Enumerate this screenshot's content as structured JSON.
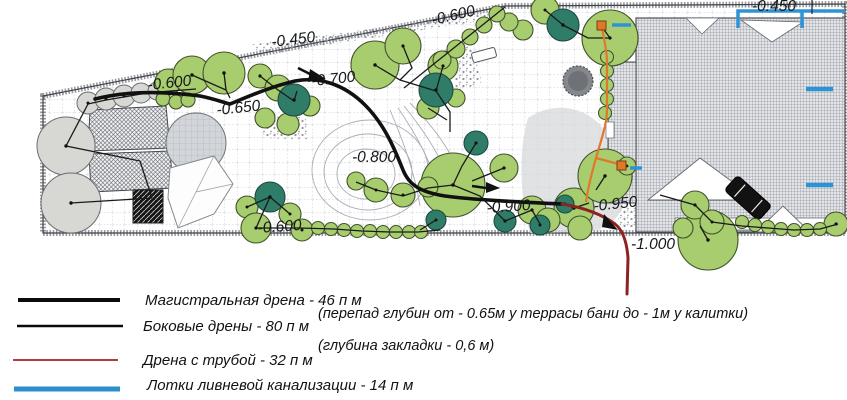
{
  "plan": {
    "depth_labels": [
      "-0.450",
      "-0.600",
      "-0.600",
      "-0.650",
      "-0.700",
      "-0.800",
      "-0.900",
      "-0.950",
      "-1.000",
      "-0.600",
      "-0.450"
    ]
  },
  "legend": {
    "items": [
      {
        "label": "Магистральная дрена - 46 п м",
        "color": "#0b0b0b",
        "weight": 4
      },
      {
        "label": "Боковые  дрены -  80 п м",
        "color": "#0b0b0b",
        "weight": 2.4
      },
      {
        "label": "Дрена с трубой - 32 п м",
        "color": "#b23b45",
        "weight": 2
      },
      {
        "label": "Лотки ливневой канализации - 14 п м",
        "color": "#2e8fd0",
        "weight": 5
      }
    ],
    "notes": [
      "(перепад глубин от - 0.65м у террасы бани  до - 1м у калитки)",
      "(глубина закладки - 0,6 м)"
    ]
  },
  "colors": {
    "main_drain": "#111111",
    "side_drain": "#1a1a1a",
    "pipe_drain_lower": "#8b2320",
    "pipe_drain_upper": "#e0782a",
    "storm_gutter": "#2e93d5",
    "tree_light": "#a8cd6e",
    "tree_dark": "#2f7d68",
    "tree_gray": "#d7d7d3"
  }
}
